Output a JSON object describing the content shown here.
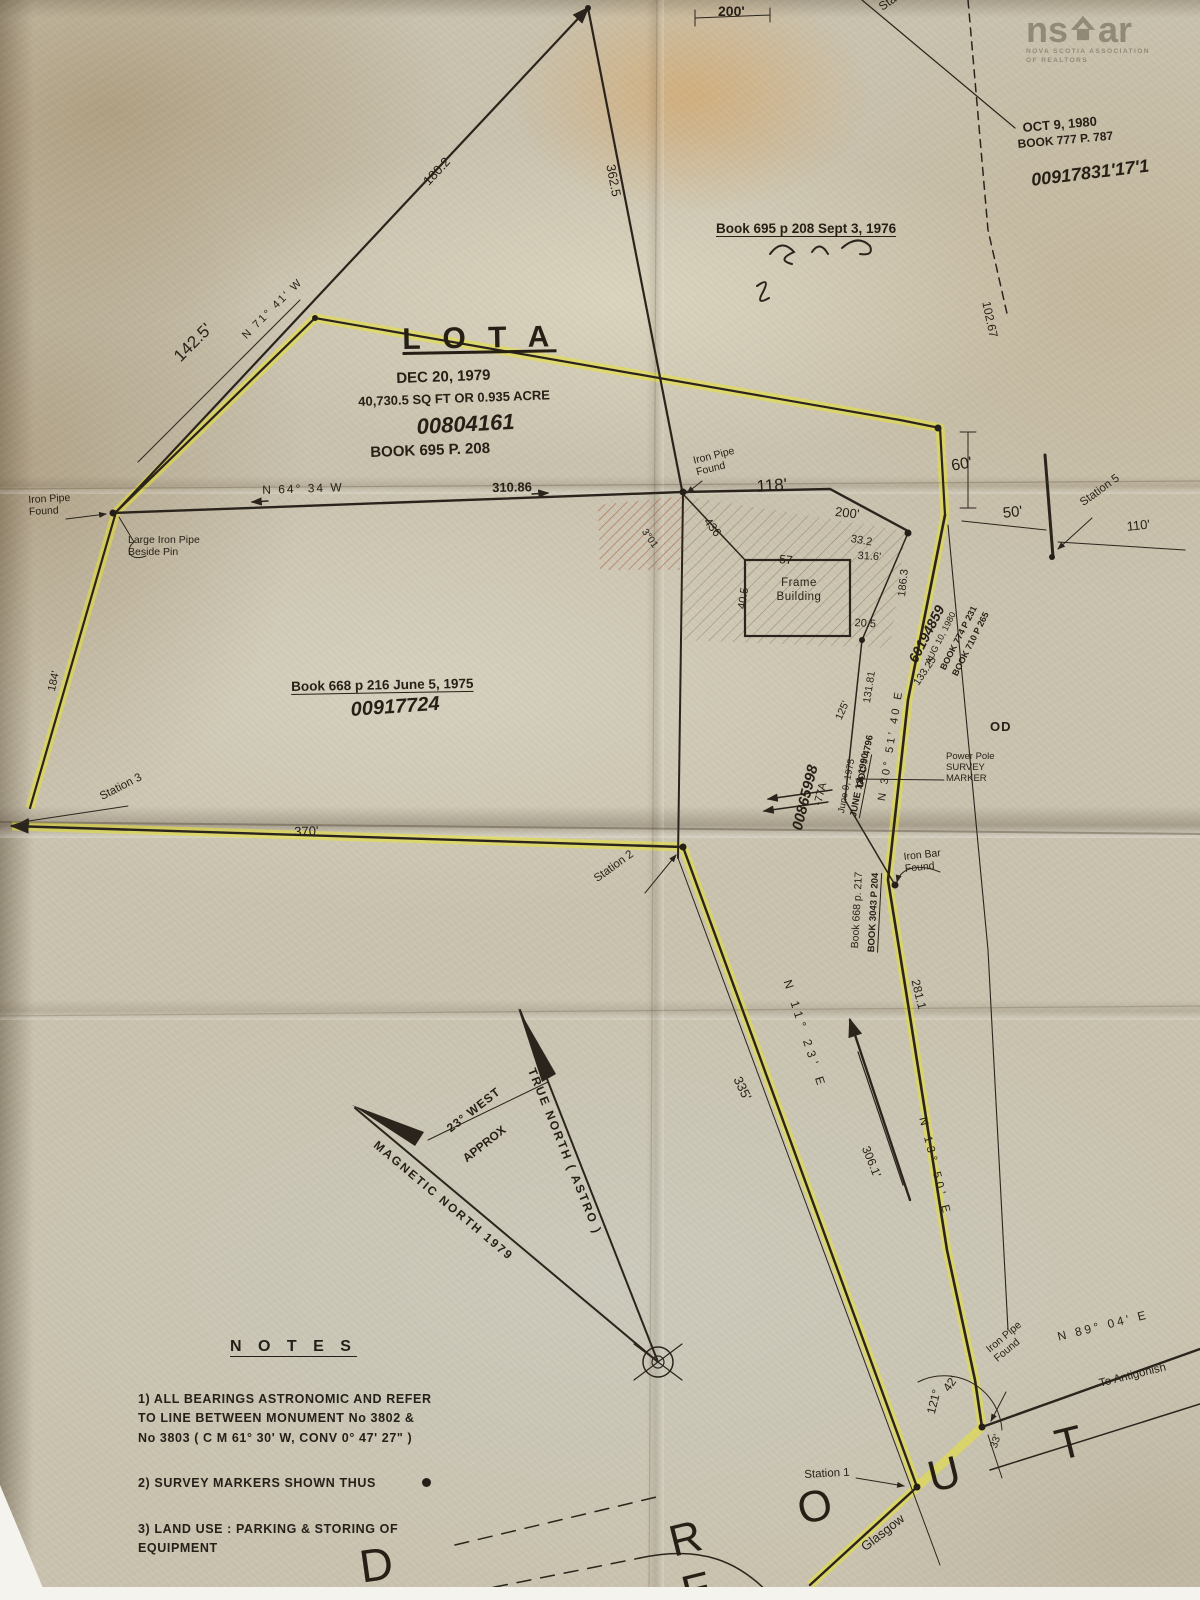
{
  "colors": {
    "paper": "#c9c2ae",
    "ink": "#2b241c",
    "highlight_yellow": "#e7e234",
    "hatch_red": "#a05a38",
    "stain_orange": "#de9440",
    "white_edge": "#f4f3ee",
    "logo_gray": "#807c72"
  },
  "watermark": {
    "logo_left": "ns",
    "logo_right": "ar",
    "house_icon": "house-icon",
    "tagline1": "NOVA SCOTIA ASSOCIATION",
    "tagline2": "OF REALTORS"
  },
  "notes": {
    "title": "N O T E S",
    "item1": "1) ALL BEARINGS ASTRONOMIC AND REFER\n    TO LINE BETWEEN MONUMENT  No 3802 &\n    No 3803 ( C M 61° 30' W,  CONV 0° 47' 27\" )",
    "item2": "2) SURVEY MARKERS SHOWN THUS",
    "item3": "3) LAND USE : PARKING & STORING OF\n    EQUIPMENT"
  },
  "labels": [
    {
      "name": "dim-200-top",
      "text": "200'",
      "x": 718,
      "y": 3,
      "fs": 14,
      "b": 1
    },
    {
      "name": "station-4-label",
      "text": "Station 4",
      "x": 876,
      "y": 2,
      "rot": -35,
      "fs": 12
    },
    {
      "name": "date-oct-9-1980",
      "text": "OCT 9, 1980",
      "x": 1022,
      "y": 120,
      "rot": -5,
      "fs": 13,
      "b": 1
    },
    {
      "name": "book-777-p-787",
      "text": "BOOK 777 P. 787",
      "x": 1017,
      "y": 137,
      "rot": -5,
      "fs": 12,
      "b": 1
    },
    {
      "name": "pid-00917831",
      "text": "00917831'17'1",
      "x": 1030,
      "y": 170,
      "rot": -7,
      "fs": 18,
      "cls": "script"
    },
    {
      "name": "book-695-sept-1976",
      "text": "Book 695 p 208  Sept 3, 1976",
      "x": 716,
      "y": 221,
      "fs": 13.5,
      "b": 1,
      "u": 1
    },
    {
      "name": "dim-180-2",
      "text": "180.2",
      "x": 420,
      "y": 178,
      "rot": -47,
      "fs": 13
    },
    {
      "name": "dim-362-5",
      "text": "362.5",
      "x": 618,
      "y": 163,
      "rot": 79,
      "fs": 13
    },
    {
      "name": "dim-102-67",
      "text": "102.67",
      "x": 993,
      "y": 300,
      "rot": 78,
      "fs": 12
    },
    {
      "name": "dim-142-5",
      "text": "142.5'",
      "x": 170,
      "y": 352,
      "rot": -45,
      "fs": 17
    },
    {
      "name": "bearing-n71-41-w",
      "text": "N  71°  41'  W",
      "x": 240,
      "y": 333,
      "rot": -45,
      "fs": 11,
      "ls": 2
    },
    {
      "name": "lot-a-title",
      "text": "L O T   A",
      "x": 402,
      "y": 322,
      "rot": -1,
      "fs": 30,
      "ls": 7,
      "b": 1,
      "u": 1
    },
    {
      "name": "lot-a-date",
      "text": "DEC 20, 1979",
      "x": 396,
      "y": 370,
      "rot": -2,
      "fs": 15,
      "b": 1
    },
    {
      "name": "lot-a-area",
      "text": "40,730.5  SQ FT  OR  0.935  ACRE",
      "x": 358,
      "y": 394,
      "rot": -2,
      "fs": 13,
      "b": 1
    },
    {
      "name": "lot-a-pid",
      "text": "00804161",
      "x": 416,
      "y": 414,
      "rot": -3,
      "fs": 22,
      "cls": "script"
    },
    {
      "name": "lot-a-book",
      "text": "BOOK 695 P. 208",
      "x": 370,
      "y": 444,
      "rot": -2,
      "fs": 15,
      "b": 1
    },
    {
      "name": "iron-pipe-found-left",
      "text": "Iron Pipe\nFound",
      "x": 28,
      "y": 494,
      "rot": -3,
      "fs": 10.5
    },
    {
      "name": "large-iron-pipe-beside-pin",
      "text": "Large Iron Pipe\nBeside Pin",
      "x": 128,
      "y": 534,
      "fs": 10.5
    },
    {
      "name": "bearing-n64-34-w",
      "text": "N    64°    34    W",
      "x": 262,
      "y": 483,
      "rot": -2,
      "fs": 12,
      "ls": 2
    },
    {
      "name": "dim-310-86",
      "text": "310.86",
      "x": 492,
      "y": 480,
      "rot": -1,
      "fs": 13,
      "b": 1
    },
    {
      "name": "iron-pipe-found-center",
      "text": "Iron Pipe\nFound",
      "x": 692,
      "y": 455,
      "rot": -14,
      "fs": 10.5
    },
    {
      "name": "dim-118",
      "text": "118'",
      "x": 756,
      "y": 477,
      "rot": -4,
      "fs": 17
    },
    {
      "name": "dim-436",
      "text": "436",
      "x": 712,
      "y": 515,
      "rot": 52,
      "fs": 12
    },
    {
      "name": "angle-3-01",
      "text": "3°01",
      "x": 648,
      "y": 527,
      "rot": 55,
      "fs": 10
    },
    {
      "name": "dim-200-right",
      "text": "200'",
      "x": 836,
      "y": 504,
      "rot": 6,
      "fs": 13
    },
    {
      "name": "dim-33-2",
      "text": "33.2",
      "x": 852,
      "y": 533,
      "rot": 10,
      "fs": 11
    },
    {
      "name": "dim-31-6",
      "text": "31.6'",
      "x": 858,
      "y": 550,
      "rot": 3,
      "fs": 11
    },
    {
      "name": "dim-57",
      "text": "57",
      "x": 780,
      "y": 552,
      "rot": 6,
      "fs": 12
    },
    {
      "name": "dim-40-5",
      "text": "40.5",
      "x": 736,
      "y": 608,
      "rot": -81,
      "fs": 11
    },
    {
      "name": "frame-building-label",
      "text": "Frame\nBuilding",
      "x": 770,
      "y": 577,
      "fs": 11.5,
      "ls": 0.5,
      "w": 58,
      "ta": "center"
    },
    {
      "name": "dim-20-5",
      "text": "20.5",
      "x": 855,
      "y": 617,
      "rot": 4,
      "fs": 11
    },
    {
      "name": "dim-186-3",
      "text": "186.3",
      "x": 896,
      "y": 596,
      "rot": -84,
      "fs": 11
    },
    {
      "name": "pid-60194859",
      "text": "60194859",
      "x": 905,
      "y": 658,
      "rot": -63,
      "fs": 14,
      "cls": "script"
    },
    {
      "name": "date-aug-10-1980",
      "text": "AUG 10, 1980",
      "x": 923,
      "y": 661,
      "rot": -63,
      "fs": 9
    },
    {
      "name": "book-774-p-231",
      "text": "BOOK 774 P 231",
      "x": 938,
      "y": 667,
      "rot": -63,
      "fs": 9,
      "b": 1
    },
    {
      "name": "book-710-p-265",
      "text": "BOOK 710 P 265",
      "x": 950,
      "y": 673,
      "rot": -63,
      "fs": 9,
      "b": 1
    },
    {
      "name": "dim-133-25",
      "text": "133.25",
      "x": 911,
      "y": 681,
      "rot": -56,
      "fs": 10.5
    },
    {
      "name": "bearing-n30-51-40-e",
      "text": "N   30°   51'   40   E",
      "x": 876,
      "y": 800,
      "rot": -81,
      "fs": 11,
      "ls": 3
    },
    {
      "name": "dim-131-81",
      "text": "131.81",
      "x": 861,
      "y": 702,
      "rot": -81,
      "fs": 10.5
    },
    {
      "name": "dim-125",
      "text": "125'",
      "x": 833,
      "y": 717,
      "rot": -66,
      "fs": 10.5
    },
    {
      "name": "doc-4796",
      "text": "DOC # 4796",
      "x": 855,
      "y": 786,
      "rot": -79,
      "fs": 9.5,
      "b": 1
    },
    {
      "name": "date-june-9-1975",
      "text": "June 9, 1975",
      "x": 836,
      "y": 812,
      "rot": -79,
      "fs": 9.5
    },
    {
      "name": "date-june-12-1990",
      "text": "JUNE 12, 1990",
      "x": 848,
      "y": 816,
      "rot": -79,
      "fs": 9.5,
      "b": 1,
      "u": 1
    },
    {
      "name": "pid-00865998",
      "text": "00865998",
      "x": 789,
      "y": 828,
      "rot": -76,
      "fs": 15,
      "cls": "script"
    },
    {
      "name": "pid-77a",
      "text": "-77A",
      "x": 812,
      "y": 804,
      "rot": -76,
      "fs": 11
    },
    {
      "name": "power-pole-survey-marker",
      "text": "Power Pole\nSURVEY\nMARKER",
      "x": 946,
      "y": 751,
      "fs": 9.5
    },
    {
      "name": "label-od",
      "text": "OD",
      "x": 990,
      "y": 719,
      "fs": 13,
      "b": 1,
      "ls": 1
    },
    {
      "name": "book-668-p-216",
      "text": "Book 668 p 216   June 5, 1975",
      "x": 291,
      "y": 679,
      "rot": -1,
      "fs": 13.5,
      "b": 1,
      "u": 1
    },
    {
      "name": "pid-00917724",
      "text": "00917724",
      "x": 350,
      "y": 699,
      "rot": -4,
      "fs": 20,
      "cls": "script"
    },
    {
      "name": "dim-184",
      "text": "184'",
      "x": 46,
      "y": 690,
      "rot": -78,
      "fs": 11
    },
    {
      "name": "station-3-label",
      "text": "Station 3",
      "x": 98,
      "y": 792,
      "rot": -27,
      "fs": 11.5
    },
    {
      "name": "dim-370",
      "text": "370'",
      "x": 294,
      "y": 824,
      "rot": -2,
      "fs": 13
    },
    {
      "name": "station-2-label",
      "text": "Station 2",
      "x": 592,
      "y": 875,
      "rot": -36,
      "fs": 11.5
    },
    {
      "name": "iron-bar-found",
      "text": "Iron Bar\nFound",
      "x": 903,
      "y": 851,
      "rot": -6,
      "fs": 10.5
    },
    {
      "name": "book-668-p-217",
      "text": "Book 668 p. 217",
      "x": 849,
      "y": 948,
      "rot": -87,
      "fs": 10.5
    },
    {
      "name": "book-3043-p-204",
      "text": "BOOK 3043 P 204",
      "x": 866,
      "y": 952,
      "rot": -87,
      "fs": 9.5,
      "b": 1,
      "u": 1
    },
    {
      "name": "dim-335",
      "text": "335'",
      "x": 744,
      "y": 1074,
      "rot": 64,
      "fs": 13
    },
    {
      "name": "bearing-n11-23-e",
      "text": "N   11°   23'   E",
      "x": 794,
      "y": 978,
      "rot": 72,
      "fs": 12,
      "ls": 5
    },
    {
      "name": "dim-306-1",
      "text": "306.1'",
      "x": 872,
      "y": 1144,
      "rot": 68,
      "fs": 12
    },
    {
      "name": "dim-281-1",
      "text": "281.1",
      "x": 922,
      "y": 978,
      "rot": 76,
      "fs": 12
    },
    {
      "name": "bearing-n13-50-e",
      "text": "N   13°   50'   E",
      "x": 928,
      "y": 1116,
      "rot": 76,
      "fs": 11.5,
      "ls": 4
    },
    {
      "name": "declination-23-west",
      "text": "23° WEST",
      "x": 444,
      "y": 1124,
      "rot": -38,
      "fs": 12,
      "ls": 1,
      "b": 1
    },
    {
      "name": "declination-approx",
      "text": "APPROX",
      "x": 460,
      "y": 1154,
      "rot": -38,
      "fs": 12,
      "b": 1
    },
    {
      "name": "true-north-label",
      "text": "TRUE   NORTH   ( ASTRO )",
      "x": 538,
      "y": 1066,
      "rot": 68,
      "fs": 12,
      "ls": 2,
      "b": 1
    },
    {
      "name": "magnetic-north-label",
      "text": "MAGNETIC    NORTH    1979",
      "x": 380,
      "y": 1138,
      "rot": 40,
      "fs": 12,
      "ls": 2,
      "b": 1
    },
    {
      "name": "station-1-label",
      "text": "Station 1",
      "x": 804,
      "y": 1469,
      "rot": -3,
      "fs": 11.5
    },
    {
      "name": "angle-121",
      "text": "121°",
      "x": 924,
      "y": 1412,
      "rot": -76,
      "fs": 12
    },
    {
      "name": "angle-42",
      "text": "42'",
      "x": 940,
      "y": 1386,
      "rot": -55,
      "fs": 12
    },
    {
      "name": "iron-pipe-found-bottom",
      "text": "Iron Pipe\nFound",
      "x": 984,
      "y": 1346,
      "rot": -40,
      "fs": 10.5
    },
    {
      "name": "bearing-n89-04-e",
      "text": "N   89°  04'   E",
      "x": 1056,
      "y": 1330,
      "rot": -14,
      "fs": 12,
      "ls": 3
    },
    {
      "name": "to-antigonish",
      "text": "To  Antigonish",
      "x": 1098,
      "y": 1378,
      "rot": -14,
      "fs": 11.5
    },
    {
      "name": "route-name",
      "text": "R  O  U  T  E",
      "x": 664,
      "y": 1518,
      "rot": -14,
      "fs": 44,
      "ls": 44
    },
    {
      "name": "road-letter-d",
      "text": "D",
      "x": 356,
      "y": 1540,
      "rot": -8,
      "fs": 46
    },
    {
      "name": "glasgow-label",
      "text": "Glasgow",
      "x": 858,
      "y": 1542,
      "rot": -38,
      "fs": 13
    },
    {
      "name": "dim-33-bottom",
      "text": "33'",
      "x": 988,
      "y": 1446,
      "rot": -72,
      "fs": 10.5
    },
    {
      "name": "dim-60",
      "text": "60'",
      "x": 950,
      "y": 458,
      "rot": -10,
      "fs": 16
    },
    {
      "name": "dim-50",
      "text": "50'",
      "x": 1002,
      "y": 505,
      "rot": -6,
      "fs": 15
    },
    {
      "name": "station-5-label",
      "text": "Station 5",
      "x": 1078,
      "y": 499,
      "rot": -36,
      "fs": 11.5
    },
    {
      "name": "dim-110",
      "text": "110'",
      "x": 1126,
      "y": 519,
      "rot": -6,
      "fs": 13
    }
  ]
}
